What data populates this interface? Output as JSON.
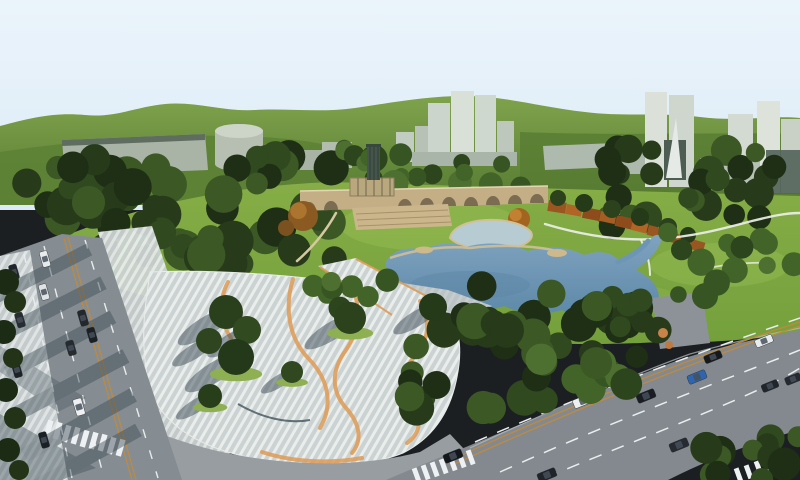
{
  "scene": {
    "palette": {
      "sky": "#e7f1f9",
      "hills_light": "#7fa34c",
      "hills_dark": "#567a31",
      "lawn": "#7ca43f",
      "lawn_light": "#93ba52",
      "forest": "#273b1a",
      "pond": "#6d96b6",
      "pond_deep": "#5d86a6",
      "shallow": "#b7ccd2",
      "sand": "#cdb98c",
      "bridge": "#c4ae86",
      "arch_dark": "#6f6149",
      "deck": "#b3bbbe",
      "plaza": "#cbd2d2",
      "plaza_stripe": "#e9edec",
      "plaza_orange": "#de9b55",
      "road": "#868d92",
      "road_right": "#83898e",
      "road_light": "#979da1",
      "lane_orange": "#c08a3c",
      "lane_white": "#eef1f3",
      "shadow": "#3c4b55",
      "rust": "#9a5621",
      "building_light": "#d9e0d8",
      "building_mid": "#bcc6bb",
      "glass_dark": "#53635a",
      "car_blue": "#2f64ae"
    },
    "tree_palettes": {
      "dark": [
        "#1e2f15",
        "#273b1a",
        "#31491f",
        "#3b5825"
      ],
      "mid": [
        "#2c451d",
        "#375423",
        "#426428",
        "#4d7030"
      ]
    },
    "tree_bands": [
      {
        "layer": "g-forest-l1",
        "x": 0,
        "y": 166,
        "w": 150,
        "h": 62,
        "n": 16,
        "rmin": 11,
        "rmax": 20,
        "pal": "dark",
        "seed": 11
      },
      {
        "layer": "g-forest-l1",
        "x": 70,
        "y": 156,
        "w": 265,
        "h": 56,
        "n": 24,
        "rmin": 10,
        "rmax": 19,
        "pal": "dark",
        "seed": 23
      },
      {
        "layer": "g-forest-l1",
        "x": 140,
        "y": 210,
        "w": 196,
        "h": 54,
        "n": 18,
        "rmin": 12,
        "rmax": 21,
        "pal": "dark",
        "seed": 37
      },
      {
        "layer": "g-forest-l1",
        "x": 98,
        "y": 222,
        "w": 70,
        "h": 44,
        "n": 6,
        "rmin": 10,
        "rmax": 16,
        "pal": "dark",
        "seed": 5
      },
      {
        "layer": "g-band-c",
        "x": 336,
        "y": 148,
        "w": 222,
        "h": 40,
        "n": 18,
        "rmin": 8,
        "rmax": 14,
        "pal": "mid",
        "seed": 13
      },
      {
        "layer": "g-band-r",
        "x": 558,
        "y": 146,
        "w": 242,
        "h": 80,
        "n": 30,
        "rmin": 9,
        "rmax": 16,
        "pal": "dark",
        "seed": 29
      },
      {
        "layer": "g-se",
        "x": 432,
        "y": 286,
        "w": 212,
        "h": 62,
        "n": 22,
        "rmin": 11,
        "rmax": 19,
        "pal": "dark",
        "seed": 41
      },
      {
        "layer": "g-se",
        "x": 398,
        "y": 328,
        "w": 172,
        "h": 84,
        "n": 16,
        "rmin": 11,
        "rmax": 18,
        "pal": "dark",
        "seed": 53
      },
      {
        "layer": "g-se",
        "x": 540,
        "y": 352,
        "w": 92,
        "h": 52,
        "n": 8,
        "rmin": 10,
        "rmax": 16,
        "pal": "mid",
        "seed": 61
      },
      {
        "layer": "g-se",
        "x": 560,
        "y": 300,
        "w": 100,
        "h": 70,
        "n": 10,
        "rmin": 10,
        "rmax": 16,
        "pal": "dark",
        "seed": 67
      },
      {
        "layer": "g-se",
        "x": 295,
        "y": 280,
        "w": 100,
        "h": 30,
        "n": 8,
        "rmin": 8,
        "rmax": 12,
        "pal": "mid",
        "seed": 97
      },
      {
        "layer": "g-lawn-r",
        "x": 658,
        "y": 232,
        "w": 142,
        "h": 70,
        "n": 14,
        "rmin": 8,
        "rmax": 14,
        "pal": "mid",
        "seed": 71
      },
      {
        "layer": "g-br",
        "x": 700,
        "y": 424,
        "w": 100,
        "h": 56,
        "n": 12,
        "rmin": 10,
        "rmax": 17,
        "pal": "dark",
        "seed": 83
      }
    ],
    "trees": [
      {
        "layer": "g-autumn",
        "x": 303,
        "y": 216,
        "r": 15,
        "c": "#8a5a22",
        "c2": "#ab7530"
      },
      {
        "layer": "g-autumn",
        "x": 286,
        "y": 228,
        "r": 8,
        "c": "#7c5120"
      },
      {
        "layer": "g-autumn",
        "x": 519,
        "y": 219,
        "r": 11,
        "c": "#a2641f",
        "c2": "#c28132"
      },
      {
        "layer": "g-pergola-trees",
        "x": 558,
        "y": 198,
        "r": 8,
        "c": "#2c421d"
      },
      {
        "layer": "g-pergola-trees",
        "x": 584,
        "y": 203,
        "r": 9,
        "c": "#253a19"
      },
      {
        "layer": "g-pergola-trees",
        "x": 612,
        "y": 209,
        "r": 9,
        "c": "#2c421d"
      },
      {
        "layer": "g-pergola-trees",
        "x": 640,
        "y": 217,
        "r": 9,
        "c": "#253a19"
      },
      {
        "layer": "g-pergola-trees",
        "x": 668,
        "y": 227,
        "r": 9,
        "c": "#2c421d"
      },
      {
        "layer": "g-pergola-trees",
        "x": 688,
        "y": 235,
        "r": 8,
        "c": "#253a19"
      },
      {
        "layer": "g-singles",
        "x": 226,
        "y": 312,
        "r": 17,
        "c": "#2a401c",
        "sh": 1
      },
      {
        "layer": "g-singles",
        "x": 247,
        "y": 330,
        "r": 14,
        "c": "#324a20",
        "sh": 1
      },
      {
        "layer": "g-singles",
        "x": 236,
        "y": 357,
        "r": 18,
        "c": "#24381a",
        "sh": 1,
        "md": 1
      },
      {
        "layer": "g-singles",
        "x": 209,
        "y": 341,
        "r": 13,
        "c": "#2e4520",
        "sh": 1
      },
      {
        "layer": "g-singles",
        "x": 350,
        "y": 318,
        "r": 16,
        "c": "#2b421d",
        "sh": 1,
        "md": 1
      },
      {
        "layer": "g-singles",
        "x": 292,
        "y": 372,
        "r": 11,
        "c": "#30471f",
        "sh": 1,
        "md": 1
      },
      {
        "layer": "g-singles",
        "x": 210,
        "y": 396,
        "r": 12,
        "c": "#283e1b",
        "sh": 1,
        "md": 1
      },
      {
        "layer": "g-singles",
        "x": 433,
        "y": 307,
        "r": 14,
        "c": "#253a19",
        "sh": 1
      },
      {
        "layer": "g-edge-trees",
        "x": 6,
        "y": 282,
        "r": 13,
        "c": "#1c2b14"
      },
      {
        "layer": "g-edge-trees",
        "x": 15,
        "y": 302,
        "r": 11,
        "c": "#223317"
      },
      {
        "layer": "g-edge-trees",
        "x": 4,
        "y": 332,
        "r": 12,
        "c": "#1c2b14"
      },
      {
        "layer": "g-edge-trees",
        "x": 13,
        "y": 358,
        "r": 10,
        "c": "#223317"
      },
      {
        "layer": "g-edge-trees",
        "x": 6,
        "y": 390,
        "r": 12,
        "c": "#1c2b14"
      },
      {
        "layer": "g-edge-trees",
        "x": 15,
        "y": 418,
        "r": 11,
        "c": "#223317"
      },
      {
        "layer": "g-edge-trees",
        "x": 8,
        "y": 450,
        "r": 12,
        "c": "#1c2b14"
      },
      {
        "layer": "g-edge-trees",
        "x": 19,
        "y": 470,
        "r": 10,
        "c": "#223317"
      },
      {
        "layer": "g-bushes",
        "x": 663,
        "y": 333,
        "r": 5,
        "c": "#c9834a"
      },
      {
        "layer": "g-bushes",
        "x": 669,
        "y": 345,
        "r": 4,
        "c": "#bf7a40"
      }
    ],
    "pergola": [
      [
        549,
        200,
        18,
        11,
        9,
        "#9a5621"
      ],
      [
        567,
        204,
        16,
        10,
        10,
        "#b06527"
      ],
      [
        584,
        207,
        17,
        11,
        11,
        "#8e4c1d"
      ],
      [
        601,
        211,
        16,
        10,
        12,
        "#a55d24"
      ],
      [
        617,
        215,
        17,
        11,
        13,
        "#8e4c1d"
      ],
      [
        633,
        220,
        16,
        10,
        14,
        "#b06527"
      ],
      [
        649,
        225,
        16,
        10,
        14,
        "#9a5621"
      ],
      [
        664,
        230,
        15,
        10,
        15,
        "#8e4c1d"
      ],
      [
        678,
        234,
        15,
        10,
        15,
        "#a55d24"
      ],
      [
        692,
        239,
        14,
        10,
        16,
        "#9a5621"
      ]
    ],
    "cars": [
      [
        45,
        259,
        74,
        16,
        8,
        "#e8ebec"
      ],
      [
        44,
        292,
        74,
        16,
        8,
        "#dfe3e5"
      ],
      [
        83,
        318,
        74,
        16,
        8,
        "#23282d"
      ],
      [
        92,
        335,
        74,
        15,
        8,
        "#1b2025"
      ],
      [
        71,
        348,
        74,
        15,
        8,
        "#262b30"
      ],
      [
        79,
        407,
        74,
        17,
        9,
        "#eef0f1"
      ],
      [
        44,
        440,
        74,
        16,
        8,
        "#1b2025"
      ],
      [
        14,
        272,
        74,
        15,
        8,
        "#20252a"
      ],
      [
        20,
        320,
        74,
        15,
        8,
        "#272c31"
      ],
      [
        17,
        370,
        74,
        15,
        8,
        "#1d2227"
      ],
      [
        583,
        401,
        -22,
        20,
        9,
        "#edeff0"
      ],
      [
        646,
        396,
        -22,
        19,
        9,
        "#1a1e23"
      ],
      [
        697,
        377,
        -22,
        19,
        9,
        "#2f64ae"
      ],
      [
        713,
        357,
        -22,
        18,
        8,
        "#15191d"
      ],
      [
        764,
        341,
        -22,
        18,
        8,
        "#e9ecee"
      ],
      [
        679,
        445,
        -22,
        19,
        9,
        "#262b31"
      ],
      [
        453,
        456,
        -22,
        19,
        9,
        "#14181c"
      ],
      [
        547,
        475,
        -22,
        19,
        9,
        "#1f242a"
      ],
      [
        770,
        386,
        -22,
        17,
        8,
        "#20252b"
      ],
      [
        793,
        379,
        -22,
        16,
        8,
        "#252a30"
      ]
    ]
  }
}
